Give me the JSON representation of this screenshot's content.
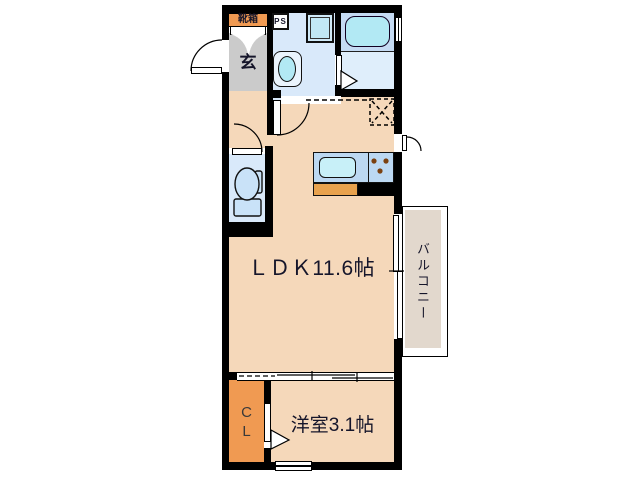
{
  "plan": {
    "title": "1K apartment floor plan",
    "labels": {
      "shoe_box": "靴箱",
      "pipe_space": "PS",
      "entrance": "玄",
      "ldk": "ＬＤＫ11.6帖",
      "balcony": "バルコニー",
      "closet": "CL",
      "bedroom": "洋室3.1帖"
    },
    "colors": {
      "wall": "#000000",
      "room_floor": "#F5D8BA",
      "accent_orange": "#F09A52",
      "kitchen_base_orange": "#E8A24E",
      "entrance_gray": "#CBCBCB",
      "wet_floor": "#D9E9FA",
      "bath_upper": "#C5DBF3",
      "bath_lower": "#DFEEFB",
      "fixture_cyan": "#B2E9F4",
      "fixture_blue": "#C9E2F8",
      "counter_blue": "#BCD8F2",
      "sink_cyan": "#C8F0F8",
      "balcony_beige": "#E2D8CD",
      "stove_dot_brown": "#7B4010"
    }
  }
}
